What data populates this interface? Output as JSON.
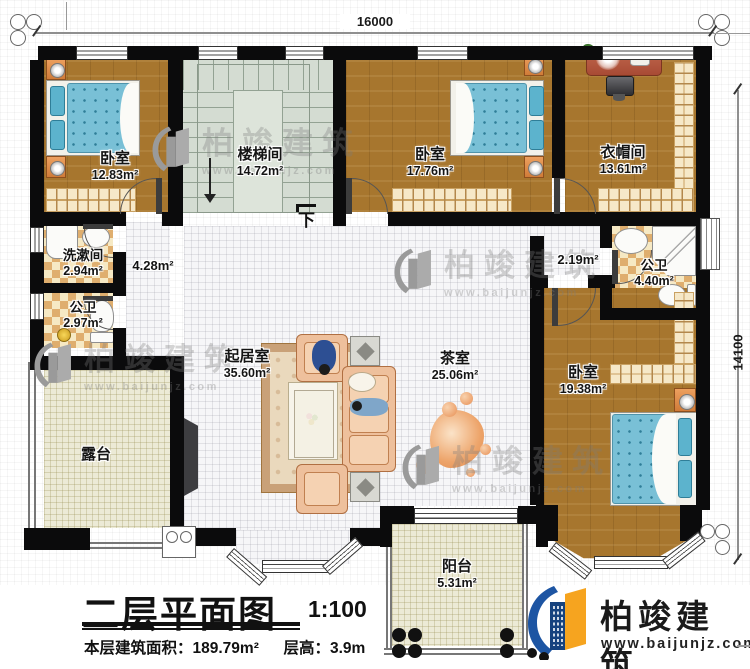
{
  "dimensions": {
    "top": "16000",
    "right": "14100"
  },
  "rooms": {
    "bedroom_tl": {
      "name": "卧室",
      "area": "12.83m²"
    },
    "stairwell": {
      "name": "楼梯间",
      "area": "14.72m²"
    },
    "bedroom_tc": {
      "name": "卧室",
      "area": "17.76m²"
    },
    "cloakroom": {
      "name": "衣帽间",
      "area": "13.61m²"
    },
    "washroom": {
      "name": "洗漱间",
      "area": "2.94m²"
    },
    "bath_left": {
      "name": "公卫",
      "area": "2.97m²"
    },
    "hall_left": {
      "area": "4.28m²"
    },
    "hall_right": {
      "area": "2.19m²"
    },
    "bath_right": {
      "name": "公卫",
      "area": "4.40m²"
    },
    "living": {
      "name": "起居室",
      "area": "35.60m²"
    },
    "tea": {
      "name": "茶室",
      "area": "25.06m²"
    },
    "bedroom_br": {
      "name": "卧室",
      "area": "19.38m²"
    },
    "terrace": {
      "name": "露台"
    },
    "balcony": {
      "name": "阳台",
      "area": "5.31m²"
    }
  },
  "annotations": {
    "stairs_down": "下"
  },
  "title_block": {
    "title": "二层平面图",
    "scale": "1:100",
    "area_line": "本层建筑面积：189.79m²",
    "height_line": "层高：3.9m"
  },
  "brand": {
    "name": "柏竣建筑",
    "website": "www.baijunjz.com"
  },
  "watermark": {
    "name": "柏竣建筑",
    "website": "www.baijunjz.com"
  },
  "colors": {
    "wall": "#0b0b0c",
    "wood_floor": "#a7762e",
    "stair_floor": "#d4dcd2",
    "tile_floor": "#f6f6f8",
    "bath_checker_dark": "#dfae6e",
    "bath_checker_light": "#f6e9c4",
    "outdoor_floor": "#ecead6",
    "bed_blue": "#79c0d6",
    "furniture_orange": "#e09a5f",
    "sofa_tan": "#eec09c",
    "brand_blue": "#1d55a3",
    "brand_orange": "#f6a41f",
    "watermark_grey": "#9a9a9a"
  }
}
